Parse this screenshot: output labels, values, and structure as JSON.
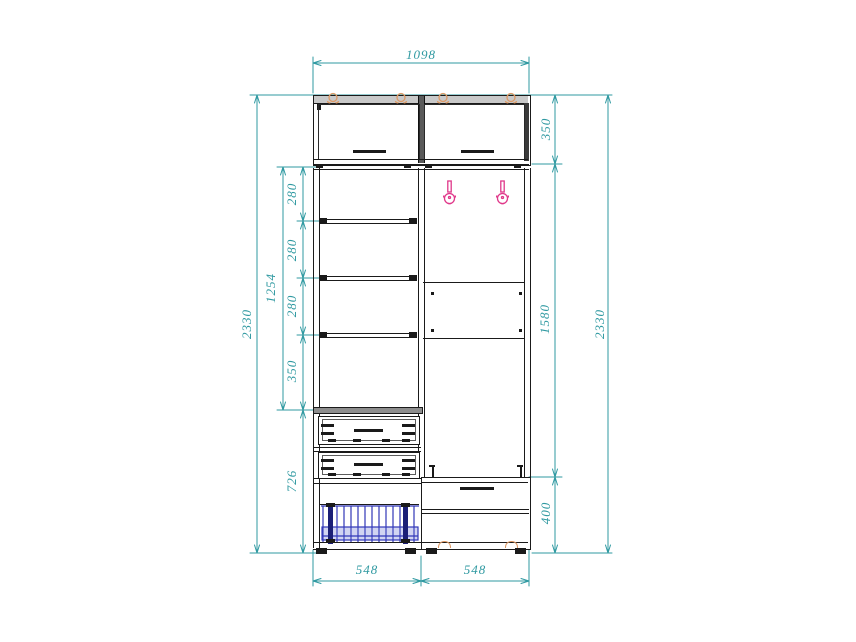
{
  "drawing": {
    "kind": "furniture-elevation-technical-drawing"
  },
  "dims": {
    "width_top": "1098",
    "height_left": "2330",
    "height_right": "2330",
    "top_section": "350",
    "middle_section": "1580",
    "bottom_section": "400",
    "shelf_column": "1254",
    "gap1": "280",
    "gap2": "280",
    "gap3": "280",
    "gap4": "350",
    "lower_column": "726",
    "base_left": "548",
    "base_right": "548"
  },
  "colors": {
    "dimension": "#2f99a1",
    "outline": "#1a1a1a",
    "hinge": "#dd9a66",
    "hook": "#e0388a",
    "shoe_rack": "#3137b8"
  }
}
